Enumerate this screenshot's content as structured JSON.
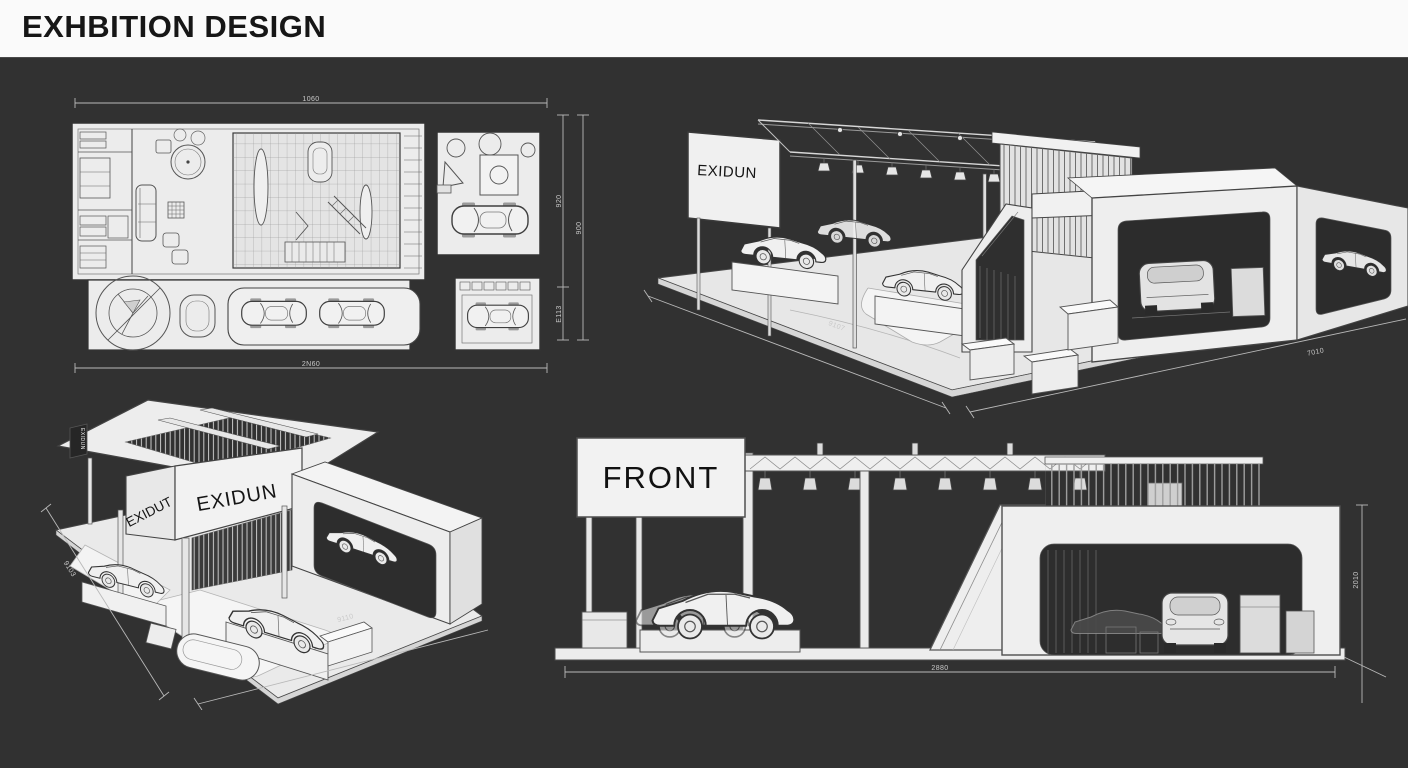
{
  "header": {
    "title": "EXHBITION DESIGN"
  },
  "colors": {
    "background": "#313131",
    "header_bg": "#fafafa",
    "title_text": "#161616",
    "drawing_panel": "#ececec",
    "line_ink": "#3c3c3c",
    "dimension_text": "#c9c9c9"
  },
  "views": {
    "floor_plan": {
      "dims": {
        "top": "1060",
        "bottom": "2N60",
        "right_inner_top": "920",
        "right_inner_bottom": "E113",
        "right_outer": "900"
      }
    },
    "iso_right": {
      "sign": "EXIDUN",
      "dims": {
        "front_edge": "9107",
        "right_edge": "7010"
      }
    },
    "iso_left": {
      "sign_main": "EXIDUN",
      "sign_side": "EXIDUT",
      "sign_small": "EXIDUN",
      "dims": {
        "left_edge": "9103",
        "front_edge": "9110"
      }
    },
    "front": {
      "label": "FRONT",
      "dims": {
        "bottom": "2880",
        "right": "2010"
      }
    }
  }
}
